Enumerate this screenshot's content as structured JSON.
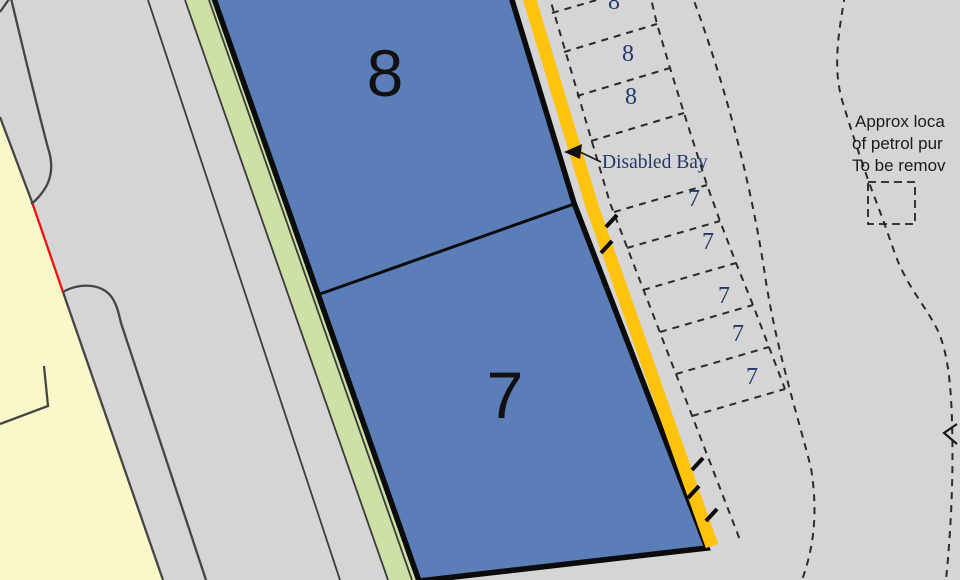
{
  "plan": {
    "title": "site-plan-detail",
    "buildings": {
      "unit8_label": "8",
      "unit7_label": "7"
    },
    "bays": {
      "row8": [
        "8",
        "8",
        "8"
      ],
      "disabled_label": "Disabled Bay",
      "row7": [
        "7",
        "7",
        "7",
        "7",
        "7"
      ]
    },
    "notes": {
      "petrol_line1": "Approx loca",
      "petrol_line2": "of petrol pur",
      "petrol_line3": "To be remov"
    },
    "colors": {
      "background": "#d5d5d5",
      "building_fill": "#5b7eb9",
      "landscape_strip": "#cde0a6",
      "adjacent_land": "#faf8c8",
      "highlight_line": "#ffc20d",
      "boundary_red": "#ee1111",
      "bay_text": "#22386b",
      "outline": "#0b0b0b"
    }
  }
}
